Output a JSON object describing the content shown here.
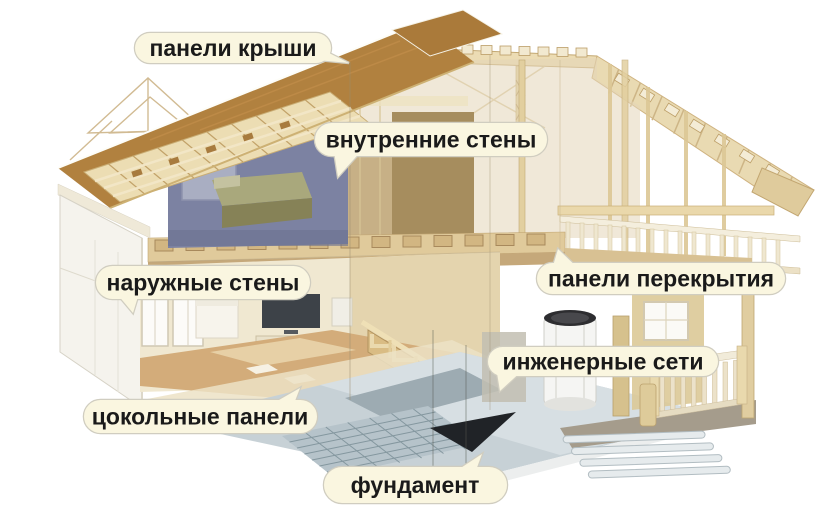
{
  "figure": {
    "description": "cutaway-house-construction-diagram",
    "language": "ru"
  },
  "labels": [
    {
      "id": "roof-panels",
      "text": "панели крыши"
    },
    {
      "id": "interior-walls",
      "text": "внутренние стены"
    },
    {
      "id": "exterior-walls",
      "text": "наружные стены"
    },
    {
      "id": "floor-panels",
      "text": "панели перекрытия"
    },
    {
      "id": "utilities",
      "text": "инженерные сети"
    },
    {
      "id": "basement-panels",
      "text": "цокольные панели"
    },
    {
      "id": "foundation",
      "text": "фундамент"
    }
  ],
  "colors": {
    "background": "#FFFFFF",
    "bubble_bg": "#FAF6E0",
    "bubble_border": "#D0CDC0",
    "bubble_text": "#1A1A1A",
    "roof_brown": "#B1813F",
    "timber_light": "#EADCB4",
    "attic_wall_blue": "#7C82A2",
    "floor_wood": "#D3AC7A",
    "foundation_gray": "#C7D1D6",
    "dark_wedge": "#202327"
  }
}
